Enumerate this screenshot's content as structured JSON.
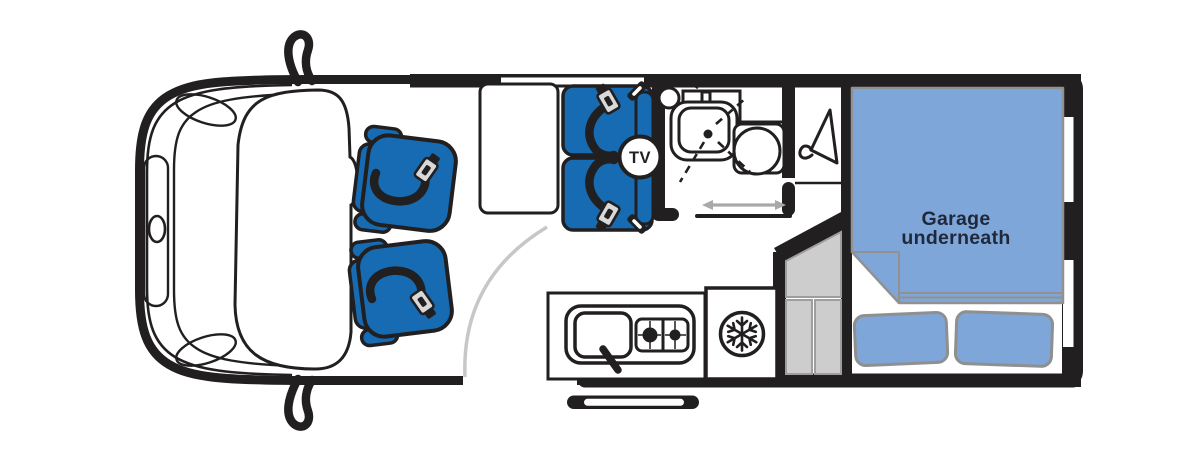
{
  "floorplan": {
    "labels": {
      "garage_line1": "Garage",
      "garage_line2": "underneath",
      "tv": "TV"
    },
    "colors": {
      "seat_blue": "#166bb2",
      "bed_blue": "#7fa6d8",
      "wall_black": "#221f20",
      "steps_gray": "#cdcdcd",
      "steps_gray_border": "#9e9e9e",
      "door_arc_gray": "#c7c7c7",
      "arrow_gray": "#a9a9a9",
      "buckle_silver": "#d9d9d9",
      "label_navy": "#20293b",
      "background": "#ffffff"
    },
    "icons": [
      "tv-badge",
      "snowflake-icon",
      "coat-hanger-icon",
      "seatbelt-buckle-icon",
      "sliding-door-arrow-icon",
      "door-swing-arc",
      "bathroom-sink-icon",
      "toilet-icon",
      "hob-icon",
      "kitchen-sink-icon",
      "wing-mirror-icon"
    ]
  }
}
